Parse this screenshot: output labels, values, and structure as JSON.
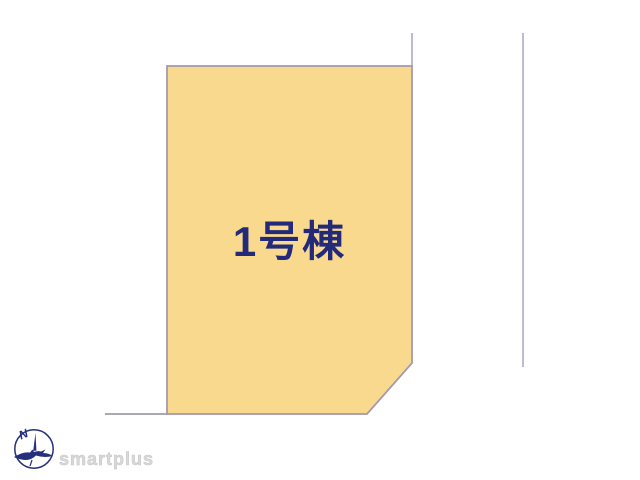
{
  "site_plan": {
    "lot": {
      "label": "1号棟",
      "fill_color": "#f9d98e",
      "border_color": "#a39aad",
      "label_color": "#232a7a"
    },
    "boundary_lines": {
      "color": "#b0a8c2",
      "ground_color": "#a9a9b3"
    }
  },
  "branding": {
    "logo_text": "smartplus",
    "logo_text_color": "#d9d9d9",
    "compass_letter": "N",
    "compass_color": "#252f7d"
  }
}
